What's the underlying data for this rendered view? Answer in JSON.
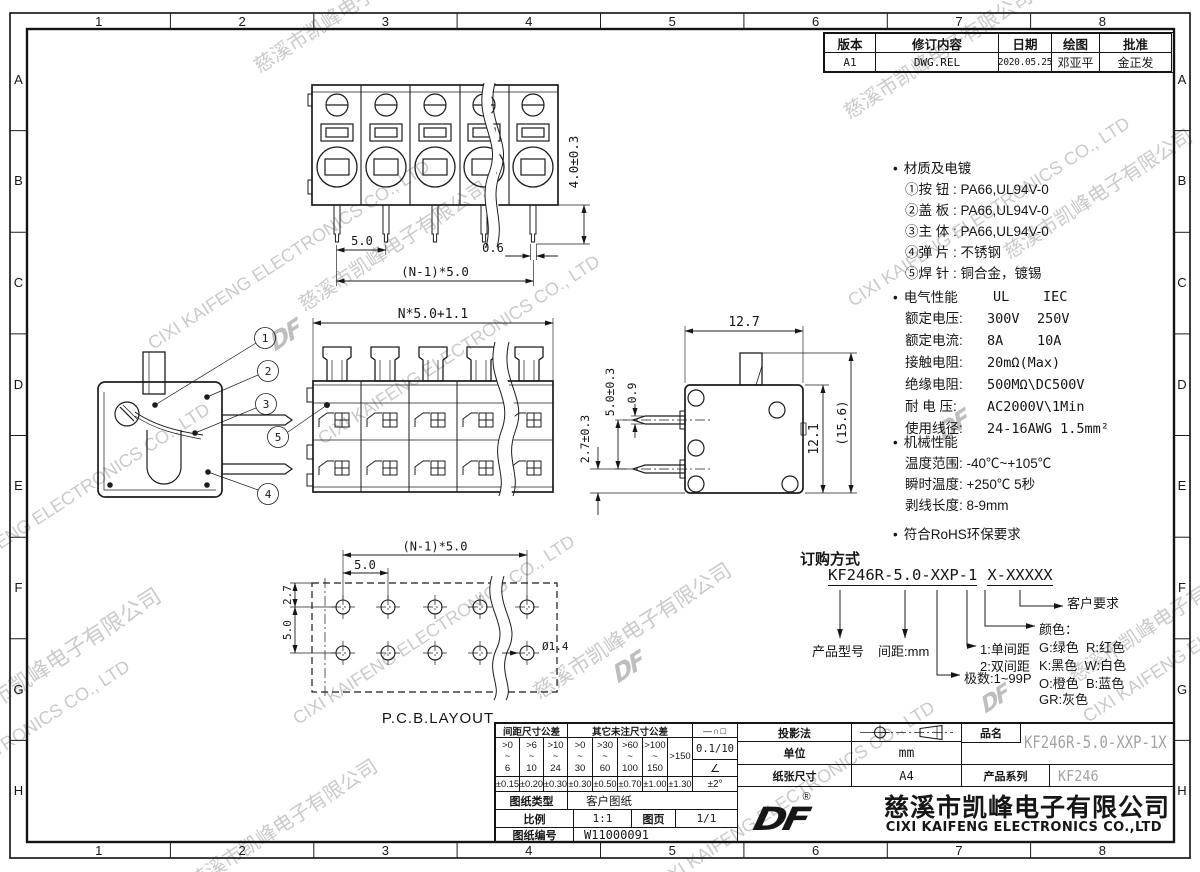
{
  "border": {
    "columns": [
      "1",
      "2",
      "3",
      "4",
      "5",
      "6",
      "7",
      "8"
    ],
    "rows": [
      "A",
      "B",
      "C",
      "D",
      "E",
      "F",
      "G",
      "H"
    ]
  },
  "revision": {
    "h_version": "版本",
    "h_content": "修订内容",
    "h_date": "日期",
    "h_draw": "绘图",
    "h_approve": "批准",
    "version": "A1",
    "content": "DWG.REL",
    "date": "2020.05.25",
    "draw": "邓亚平",
    "approve": "金正发"
  },
  "dims": {
    "front_pitch": "5.0",
    "front_pin": "0.6",
    "front_total": "(N-1)*5.0",
    "front_height": "4.0±0.3",
    "rear_total": "N*5.0+1.1",
    "seat_offset": "2.7±0.3",
    "side_width": "12.7",
    "side_pin_pitch": "5.0±0.3",
    "side_pin_w": "0.9",
    "side_body_h": "12.1",
    "side_total_h": "(15.6)",
    "pcb_total": "(N-1)*5.0",
    "pcb_pitch": "5.0",
    "pcb_row_pitch": "5.0",
    "pcb_offset": "2.7",
    "pcb_hole": "Ø1.4",
    "pcb_label": "P.C.B.LAYOUT"
  },
  "callouts": {
    "c1": "1",
    "c2": "2",
    "c3": "3",
    "c4": "4",
    "c5": "5"
  },
  "notes": {
    "bullet": "•",
    "material": {
      "title": "材质及电镀",
      "items": [
        "①按 钮 : PA66,UL94V-0",
        "②盖 板 : PA66,UL94V-0",
        "③主 体 : PA66,UL94V-0",
        "④弹 片 : 不锈钢",
        "⑤焊 针 : 铜合金，镀锡"
      ]
    },
    "electrical": {
      "title": "电气性能",
      "col_ul": "UL",
      "col_iec": "IEC",
      "rows": [
        {
          "label": "额定电压:",
          "ul": "300V",
          "iec": "250V"
        },
        {
          "label": "额定电流:",
          "ul": "8A",
          "iec": "10A"
        },
        {
          "label": "接触电阻:",
          "ul": "20mΩ(Max)",
          "iec": ""
        },
        {
          "label": "绝缘电阻:",
          "ul": "500MΩ\\DC500V",
          "iec": ""
        },
        {
          "label": "耐 电 压:",
          "ul": "AC2000V\\1Min",
          "iec": ""
        },
        {
          "label": "使用线径:",
          "ul": "24-16AWG 1.5mm²",
          "iec": ""
        }
      ]
    },
    "mechanical": {
      "title": "机械性能",
      "items": [
        "温度范围: -40℃~+105℃",
        "瞬时温度: +250℃ 5秒",
        "剥线长度: 8-9mm"
      ]
    },
    "rohs": "符合RoHS环保要求"
  },
  "ordering": {
    "title": "订购方式",
    "code_main": "KF246R-5.0-XXP-1",
    "code_suffix": "X-XXXXX",
    "model_label": "产品型号",
    "pitch_label": "间距:mm",
    "poles_label": "极数:1~99P",
    "spacing1": "1:单间距",
    "spacing2": "2:双间距",
    "color_title": "颜色：",
    "colors": [
      "G:绿色  R:红色",
      "K:黑色  W:白色",
      "O:橙色  B:蓝色",
      "GR:灰色"
    ],
    "customer_label": "客户要求"
  },
  "tol": {
    "group_pitch": "间距尺寸公差",
    "group_other": "其它未注尺寸公差",
    "ranges": [
      ">0\n~\n6",
      ">6\n~\n10",
      ">10\n~\n24",
      ">0\n~\n30",
      ">30\n~\n60",
      ">60\n~\n100",
      ">100\n~\n150",
      ">150"
    ],
    "values": [
      "±0.15",
      "±0.20",
      "±0.30",
      "±0.30",
      "±0.50",
      "±0.70",
      "±1.00",
      "±1.30"
    ],
    "sym_geo": "—∩□",
    "sym_flat": "0.1/10",
    "sym_angle": "∠",
    "sym_angle_tol": "±2°"
  },
  "doc": {
    "type_label": "图纸类型",
    "type_value": "客户图纸",
    "scale_label": "比例",
    "scale_value": "1:1",
    "page_label": "图页",
    "page_value": "1/1",
    "no_label": "图纸编号",
    "no_value": "W11000091",
    "projection_label": "投影法",
    "unit_label": "单位",
    "unit_value": "mm",
    "paper_label": "纸张尺寸",
    "paper_value": "A4",
    "name_label": "品名",
    "name_value": "KF246R-5.0-XXP-1X",
    "series_label": "产品系列",
    "series_value": "KF246"
  },
  "company": {
    "logo": "DF",
    "reg": "®",
    "name_cn": "慈溪市凯峰电子有限公司",
    "name_en": "CIXI KAIFENG ELECTRONICS CO.,LTD",
    "name_en_wm": "CIXI KAIFENG ELECTRONICS CO., LTD"
  }
}
